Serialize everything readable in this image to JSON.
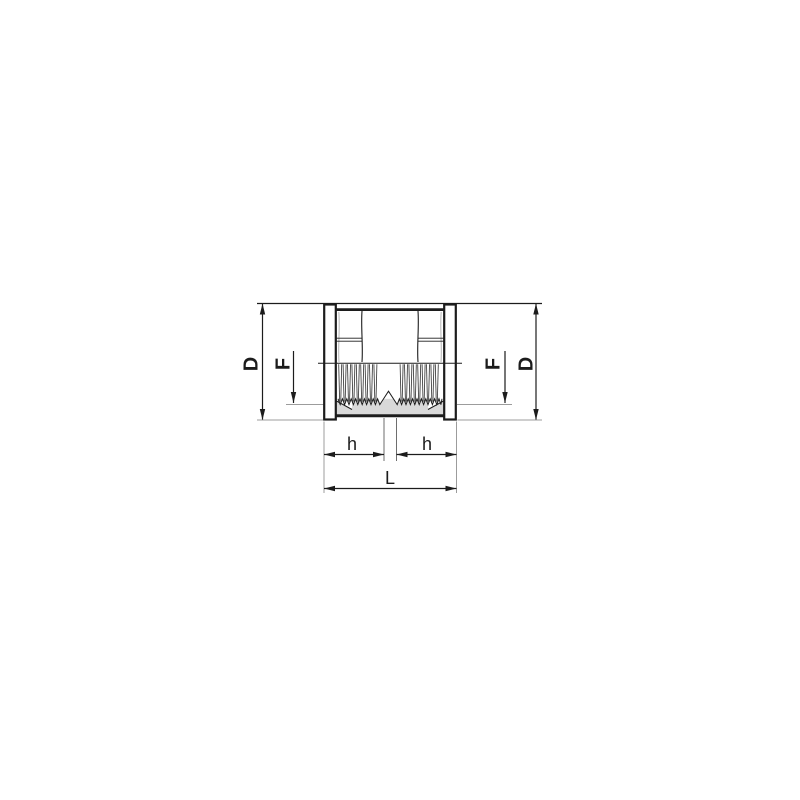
{
  "figure": {
    "type": "technical-drawing",
    "subject": "threaded-socket-half-section",
    "background_color": "#ffffff",
    "line_color": "#1c1c1c",
    "extension_line_color": "#9c9c9c",
    "section_fill_color": "#d9d9d9",
    "labels": {
      "diameter_left": "D",
      "thread_diameter_left": "F",
      "thread_diameter_right": "F",
      "diameter_right": "D",
      "thread_depth_left": "h",
      "thread_depth_right": "h",
      "overall_length": "L"
    }
  }
}
